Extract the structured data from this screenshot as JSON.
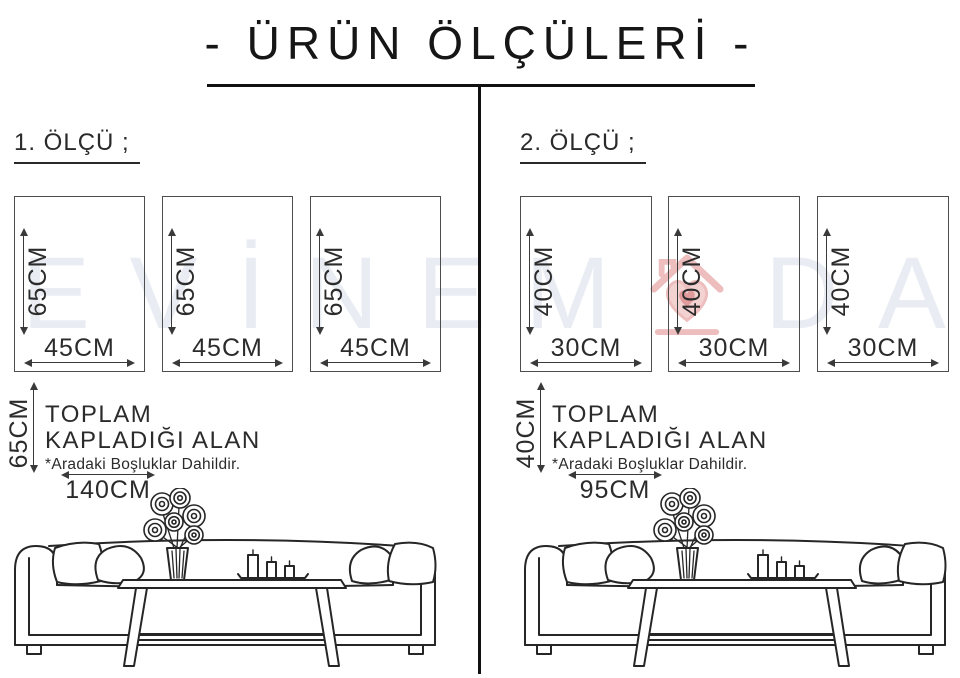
{
  "title": "- ÜRÜN ÖLÇÜLERİ -",
  "watermark": {
    "before": [
      "E",
      "V",
      "İ",
      "N",
      "E",
      "M"
    ],
    "after": [
      "D",
      "A"
    ],
    "logo": "evinemoda-home-heart-logo",
    "text_color": "#e9edf3",
    "logo_color": "#eebdbd",
    "logo_heart_color": "#e09c9c"
  },
  "sections": [
    {
      "heading": "1. ÖLÇÜ ;",
      "panels": [
        {
          "height_label": "65CM",
          "width_label": "45CM"
        },
        {
          "height_label": "65CM",
          "width_label": "45CM"
        },
        {
          "height_label": "65CM",
          "width_label": "45CM"
        }
      ],
      "total": {
        "height_label": "65CM",
        "line1": "TOPLAM",
        "line2": "KAPLADIĞI ALAN",
        "note": "*Aradaki Boşluklar Dahildir.",
        "width_label": "140CM"
      }
    },
    {
      "heading": "2. ÖLÇÜ ;",
      "panels": [
        {
          "height_label": "40CM",
          "width_label": "30CM"
        },
        {
          "height_label": "40CM",
          "width_label": "30CM"
        },
        {
          "height_label": "40CM",
          "width_label": "30CM"
        }
      ],
      "total": {
        "height_label": "40CM",
        "line1": "TOPLAM",
        "line2": "KAPLADIĞI ALAN",
        "note": "*Aradaki Boşluklar Dahildir.",
        "width_label": "95CM"
      }
    }
  ]
}
